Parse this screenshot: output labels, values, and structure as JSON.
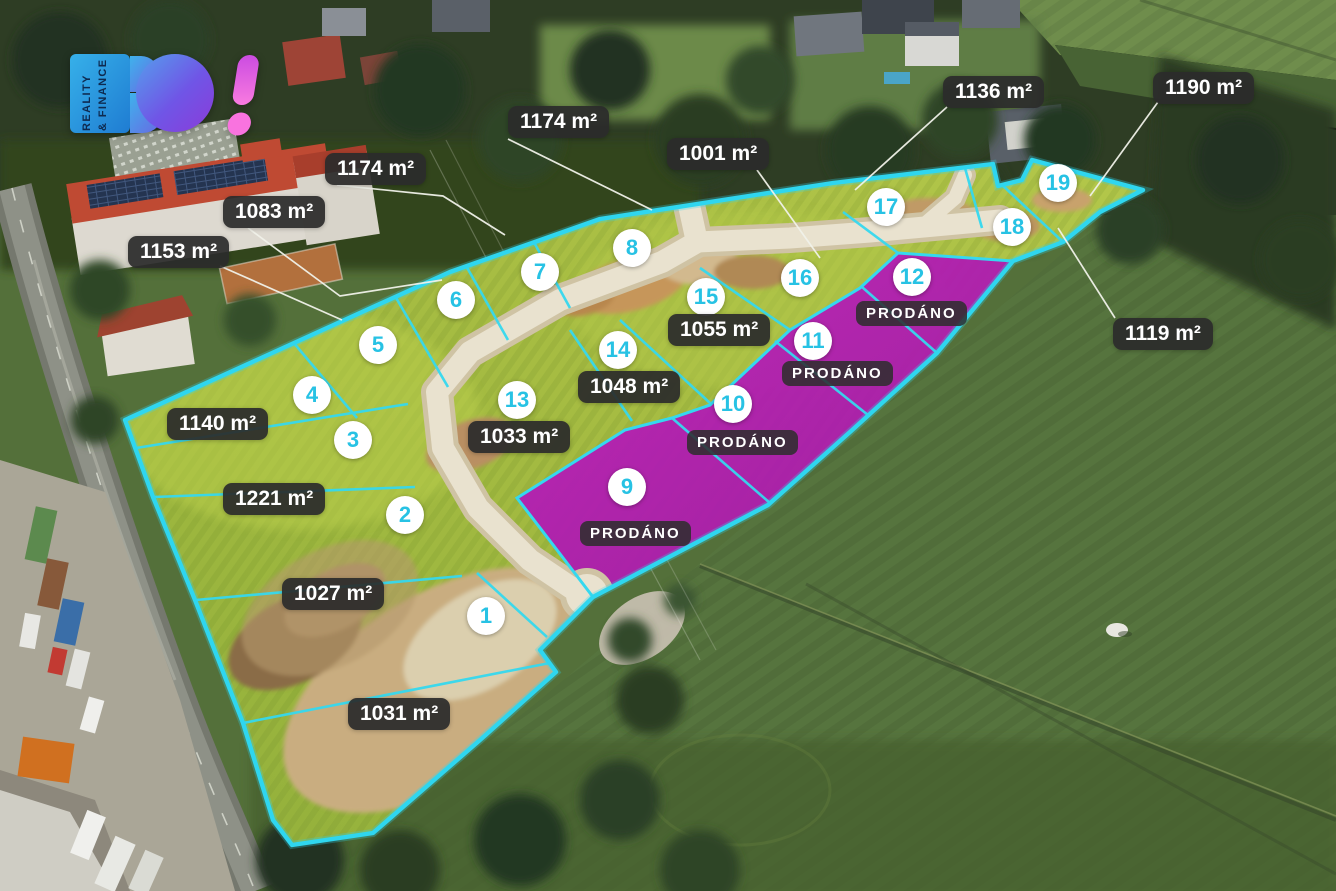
{
  "logo": {
    "brand": "BO!",
    "tagline_line1": "REALITY",
    "tagline_line2": "& FINANCE"
  },
  "colors": {
    "boundary_cyan": "#33d7ee",
    "number_cyan": "#27c2e4",
    "sold_purple": "#b216b4",
    "label_bg": "rgba(43,43,43,0.93)",
    "label_text": "#ffffff",
    "leader_line": "#f0f1e9"
  },
  "sold_status_text": "PRODÁNO",
  "plots": [
    {
      "number": "1",
      "area": "1031 m²",
      "status": "available",
      "circle": {
        "x": 486,
        "y": 616
      },
      "label": {
        "x": 348,
        "y": 698
      }
    },
    {
      "number": "2",
      "area": "1027 m²",
      "status": "available",
      "circle": {
        "x": 405,
        "y": 515
      },
      "label": {
        "x": 282,
        "y": 578
      }
    },
    {
      "number": "3",
      "area": "1221 m²",
      "status": "available",
      "circle": {
        "x": 353,
        "y": 440
      },
      "label": {
        "x": 223,
        "y": 483
      }
    },
    {
      "number": "4",
      "area": "1140 m²",
      "status": "available",
      "circle": {
        "x": 312,
        "y": 395
      },
      "label": {
        "x": 167,
        "y": 408
      }
    },
    {
      "number": "5",
      "area": "1153 m²",
      "status": "available",
      "circle": {
        "x": 378,
        "y": 345
      },
      "label": {
        "x": 128,
        "y": 236
      },
      "leader": [
        [
          220,
          266
        ],
        [
          342,
          320
        ]
      ]
    },
    {
      "number": "6",
      "area": "1083 m²",
      "status": "available",
      "circle": {
        "x": 456,
        "y": 300
      },
      "label": {
        "x": 223,
        "y": 196
      },
      "leader": [
        [
          248,
          228
        ],
        [
          340,
          296
        ],
        [
          442,
          280
        ]
      ]
    },
    {
      "number": "7",
      "area": "1174 m²",
      "status": "available",
      "circle": {
        "x": 540,
        "y": 272
      },
      "label": {
        "x": 325,
        "y": 153
      },
      "leader": [
        [
          337,
          185
        ],
        [
          443,
          196
        ],
        [
          505,
          235
        ]
      ]
    },
    {
      "number": "8",
      "area": "1174 m²",
      "status": "available",
      "circle": {
        "x": 632,
        "y": 248
      },
      "label": {
        "x": 508,
        "y": 106
      },
      "leader": [
        [
          508,
          139
        ],
        [
          652,
          210
        ]
      ]
    },
    {
      "number": "9",
      "status": "sold",
      "circle": {
        "x": 627,
        "y": 487
      },
      "label": {
        "x": 580,
        "y": 521
      }
    },
    {
      "number": "10",
      "status": "sold",
      "circle": {
        "x": 733,
        "y": 404
      },
      "label": {
        "x": 687,
        "y": 430
      }
    },
    {
      "number": "11",
      "status": "sold",
      "circle": {
        "x": 813,
        "y": 341
      },
      "label": {
        "x": 782,
        "y": 361
      }
    },
    {
      "number": "12",
      "status": "sold",
      "circle": {
        "x": 912,
        "y": 277
      },
      "label": {
        "x": 856,
        "y": 301
      }
    },
    {
      "number": "13",
      "area": "1033 m²",
      "status": "available",
      "circle": {
        "x": 517,
        "y": 400
      },
      "label": {
        "x": 468,
        "y": 421
      }
    },
    {
      "number": "14",
      "area": "1048 m²",
      "status": "available",
      "circle": {
        "x": 618,
        "y": 350
      },
      "label": {
        "x": 578,
        "y": 371
      }
    },
    {
      "number": "15",
      "area": "1055 m²",
      "status": "available",
      "circle": {
        "x": 706,
        "y": 297
      },
      "label": {
        "x": 668,
        "y": 314
      }
    },
    {
      "number": "16",
      "area": "1001 m²",
      "status": "available",
      "circle": {
        "x": 800,
        "y": 278
      },
      "label": {
        "x": 667,
        "y": 138
      },
      "leader": [
        [
          757,
          170
        ],
        [
          820,
          258
        ]
      ]
    },
    {
      "number": "17",
      "area": "1136 m²",
      "status": "available",
      "circle": {
        "x": 886,
        "y": 207
      },
      "label": {
        "x": 943,
        "y": 76
      },
      "leader": [
        [
          947,
          107
        ],
        [
          855,
          190
        ]
      ]
    },
    {
      "number": "18",
      "area": "1119 m²",
      "status": "available",
      "circle": {
        "x": 1012,
        "y": 227
      },
      "label": {
        "x": 1113,
        "y": 318
      },
      "leader": [
        [
          1115,
          318
        ],
        [
          1058,
          228
        ]
      ]
    },
    {
      "number": "19",
      "area": "1190 m²",
      "status": "available",
      "circle": {
        "x": 1058,
        "y": 183
      },
      "label": {
        "x": 1153,
        "y": 72
      },
      "leader": [
        [
          1158,
          102
        ],
        [
          1090,
          196
        ]
      ]
    }
  ]
}
